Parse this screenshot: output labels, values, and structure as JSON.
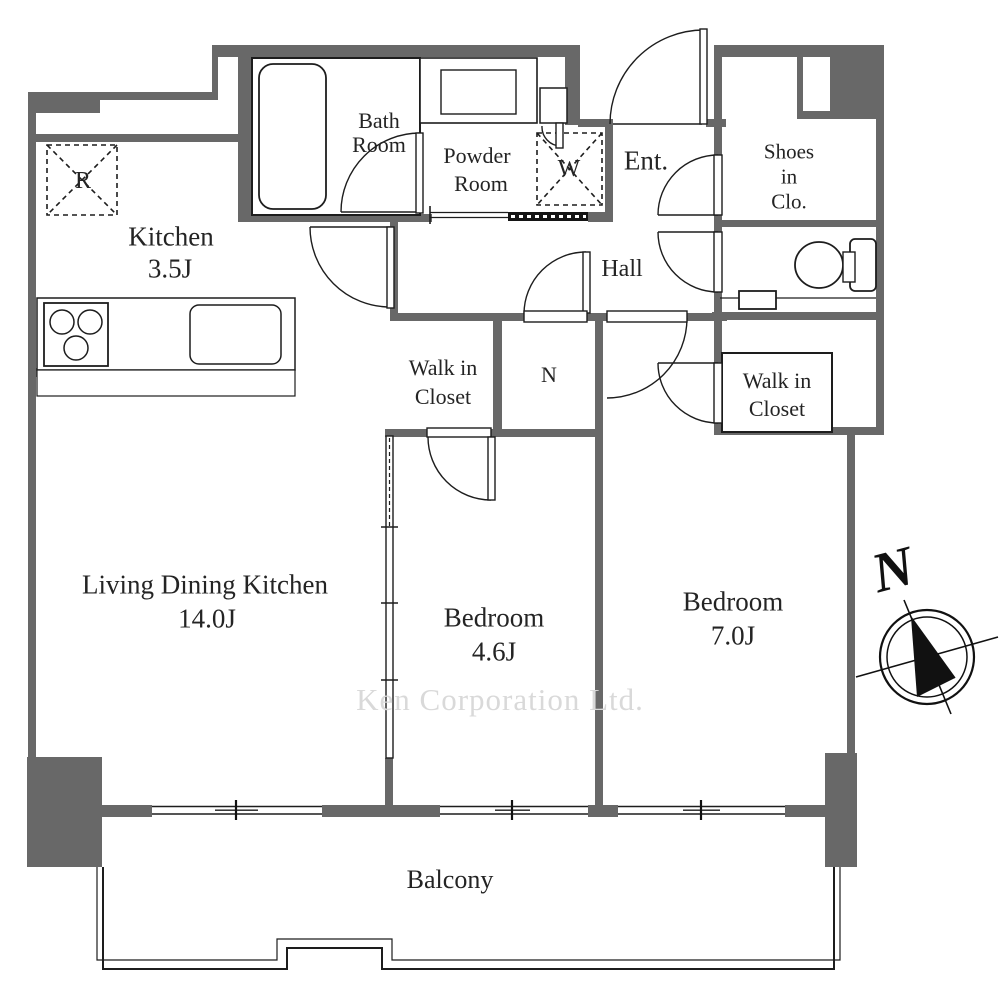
{
  "watermark": "Ken Corporation Ltd.",
  "compass": {
    "north_label": "N"
  },
  "rooms": {
    "kitchen": {
      "name": "Kitchen",
      "size": "3.5J"
    },
    "ldk": {
      "name": "Living Dining Kitchen",
      "size": "14.0J"
    },
    "bedroom_small": {
      "name": "Bedroom",
      "size": "4.6J"
    },
    "bedroom_large": {
      "name": "Bedroom",
      "size": "7.0J"
    },
    "bath": {
      "lines": [
        "Bath",
        "Room"
      ]
    },
    "powder": {
      "lines": [
        "Powder",
        "Room"
      ]
    },
    "entrance": {
      "name": "Ent."
    },
    "hall": {
      "name": "Hall"
    },
    "shoes_closet": {
      "lines": [
        "Shoes",
        "in",
        "Clo."
      ]
    },
    "walk_in_closet_a": {
      "lines": [
        "Walk in",
        "Closet"
      ]
    },
    "walk_in_closet_b": {
      "lines": [
        "Walk in",
        "Closet"
      ]
    },
    "closet_n": {
      "name": "N"
    },
    "balcony": {
      "name": "Balcony"
    }
  },
  "fixtures": {
    "refrigerator_label": "R",
    "washing_machine_label": "W"
  },
  "colors": {
    "wall": "#686868",
    "line": "#1d1d1d",
    "text": "#242424",
    "watermark": "#d9d9d9"
  }
}
